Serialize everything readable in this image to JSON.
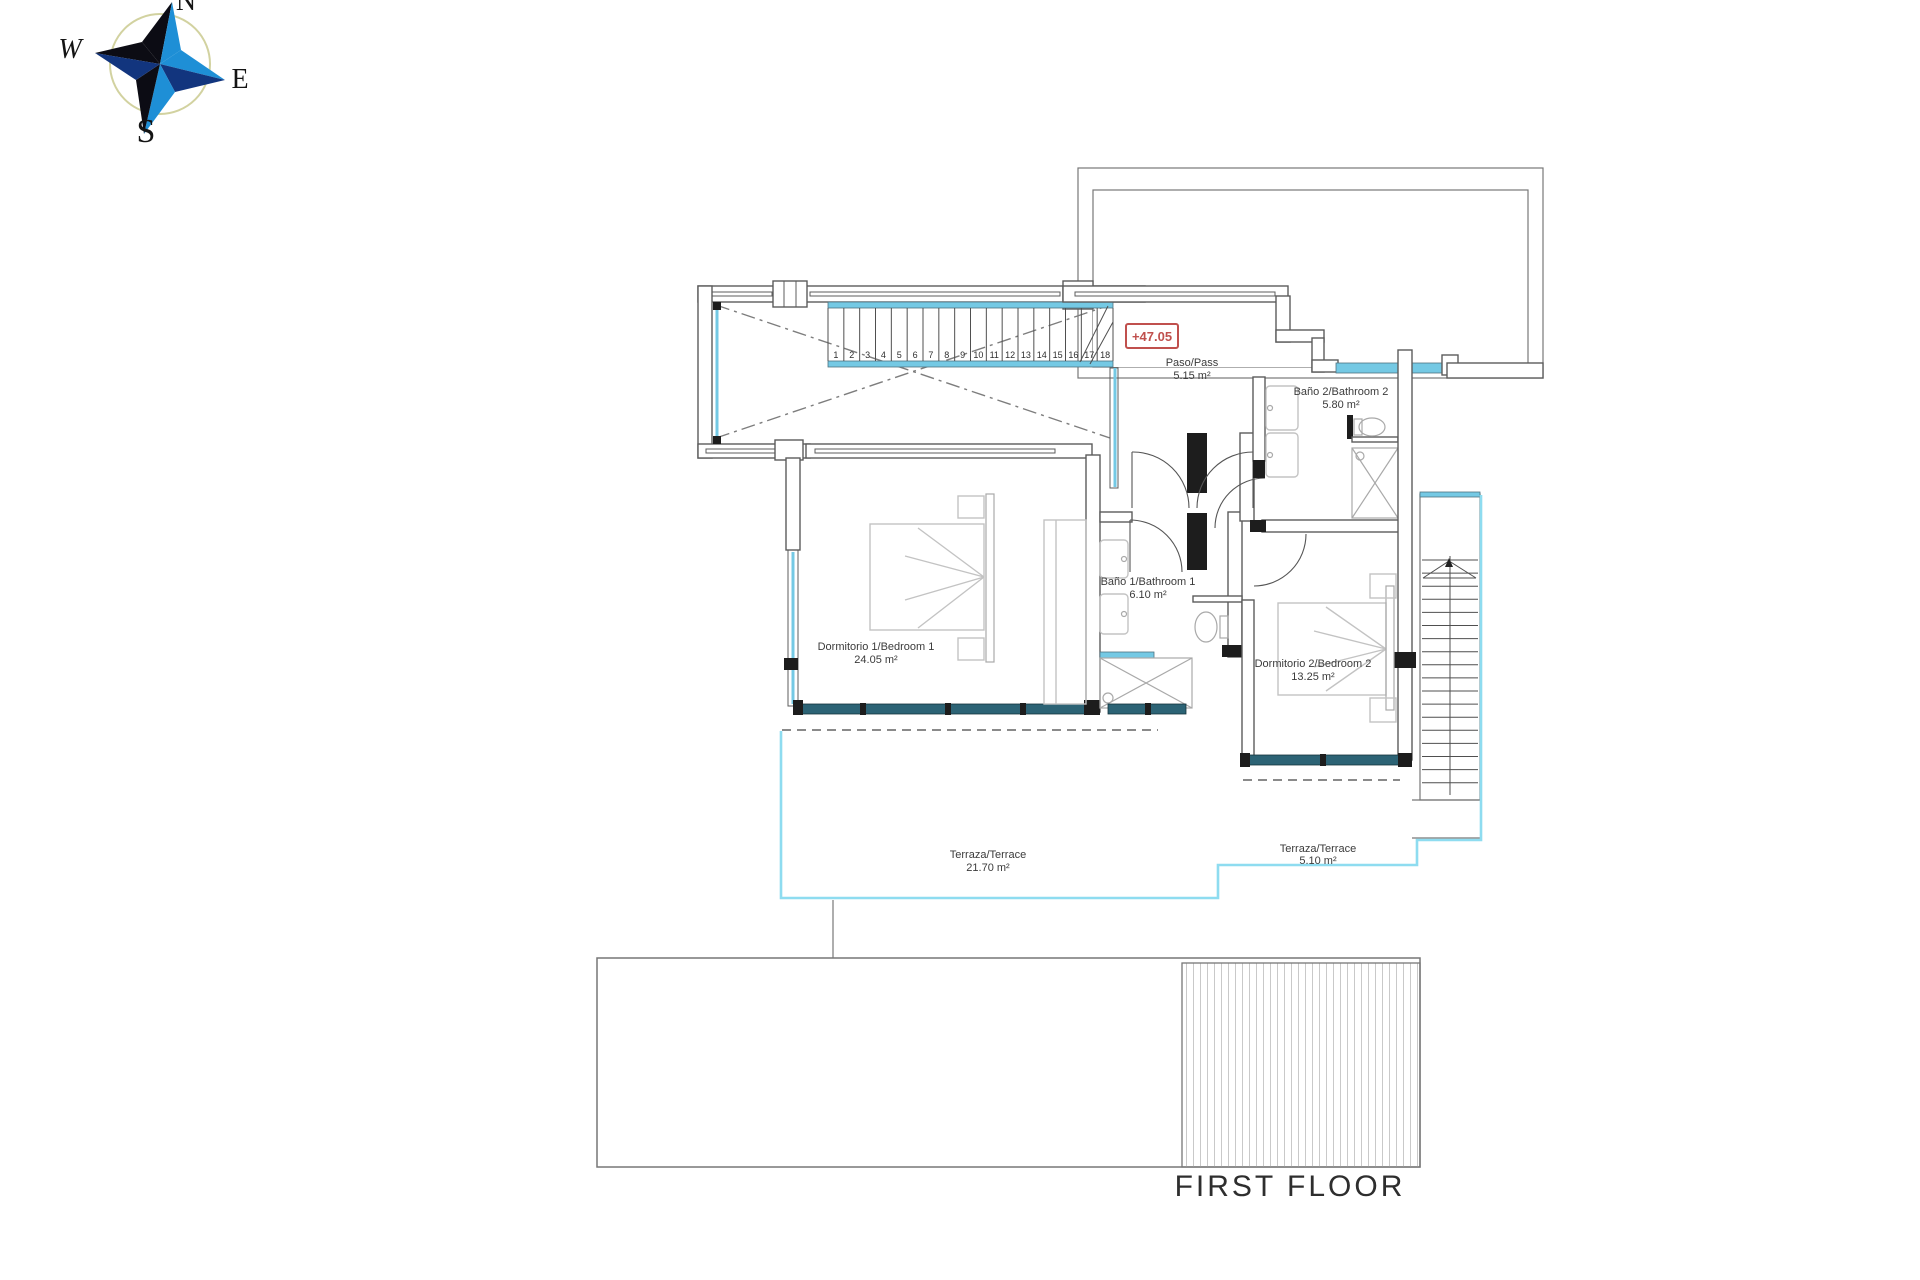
{
  "floor_label": "FIRST FLOOR",
  "elevation_marker": "+47.05",
  "compass": {
    "north": "N",
    "south": "S",
    "east": "E",
    "west": "W"
  },
  "rooms": [
    {
      "id": "paso",
      "name": "Paso/Pass",
      "area": "5.15 m²"
    },
    {
      "id": "bano2",
      "name": "Baño 2/Bathroom 2",
      "area": "5.80 m²"
    },
    {
      "id": "dormitorio1",
      "name": "Dormitorio 1/Bedroom 1",
      "area": "24.05 m²"
    },
    {
      "id": "bano1",
      "name": "Baño 1/Bathroom 1",
      "area": "6.10 m²"
    },
    {
      "id": "dormitorio2",
      "name": "Dormitorio 2/Bedroom 2",
      "area": "13.25 m²"
    },
    {
      "id": "terraza1",
      "name": "Terraza/Terrace",
      "area": "21.70 m²"
    },
    {
      "id": "terraza2",
      "name": "Terraza/Terrace",
      "area": "5.10 m²"
    }
  ],
  "stairs": {
    "treads": [
      "1",
      "2",
      "3",
      "4",
      "5",
      "6",
      "7",
      "8",
      "9",
      "10",
      "11",
      "12",
      "13",
      "14",
      "15",
      "16",
      "17",
      "18"
    ]
  },
  "colors": {
    "glass": "#74c9e4",
    "window_band": "#2c6375",
    "terrace_line": "#8edcf0",
    "elevation_red": "#c0504d",
    "gravel_dot": "#9c9c9c",
    "gravel_triangle": "#2b2b2b",
    "compass_blue": "#1e8fd6",
    "compass_navy": "#12357e",
    "compass_dark": "#0c0c14",
    "compass_ring": "#d2d2a0"
  }
}
